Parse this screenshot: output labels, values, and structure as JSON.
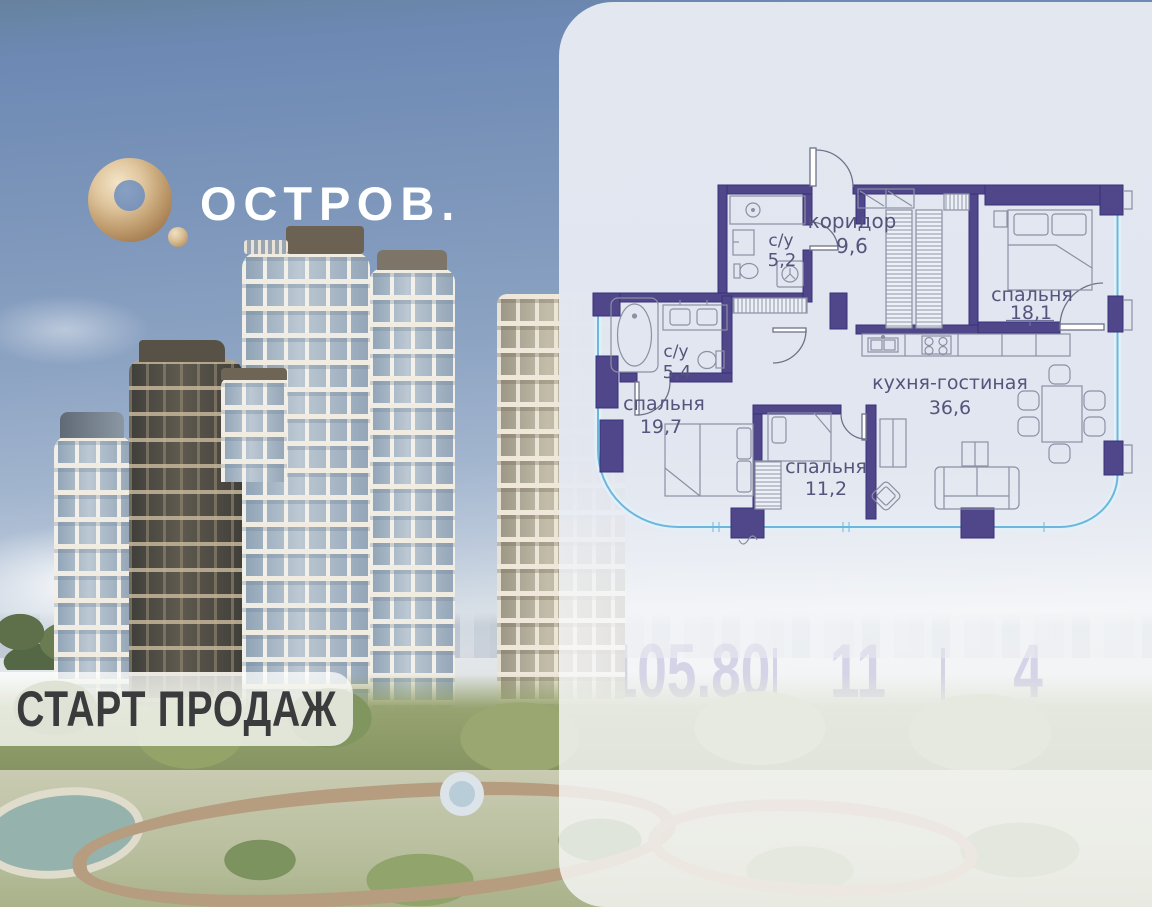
{
  "brand": {
    "name": "ОСТРОВ.",
    "logo_icon": "gold-ring"
  },
  "badge": {
    "label": "СТАРТ ПРОДАЖ"
  },
  "plan": {
    "rooms": [
      {
        "name": "с/у",
        "area": "5,2"
      },
      {
        "name": "коридор",
        "area": "9,6"
      },
      {
        "name": "спальня",
        "area": "18,1"
      },
      {
        "name": "с/у",
        "area": "5,4"
      },
      {
        "name": "спальня",
        "area": "19,7"
      },
      {
        "name": "спальня",
        "area": "11,2"
      },
      {
        "name": "кухня-гостиная",
        "area": "36,6"
      }
    ],
    "colors": {
      "wall": "#4f4789",
      "glazing": "#6fb6dc",
      "furniture": "#8b90a4",
      "label": "#55547c"
    }
  },
  "stats": [
    {
      "value": "105.80",
      "label": "площадь"
    },
    {
      "value": "11",
      "label": "этаж"
    },
    {
      "value": "4",
      "label": "комнат"
    }
  ],
  "colors": {
    "accent": "#4a3e97",
    "card": "#e3e7f0",
    "text_dark": "#2f2f33",
    "gold": "#c9a674",
    "sky": "#7e97bb"
  }
}
